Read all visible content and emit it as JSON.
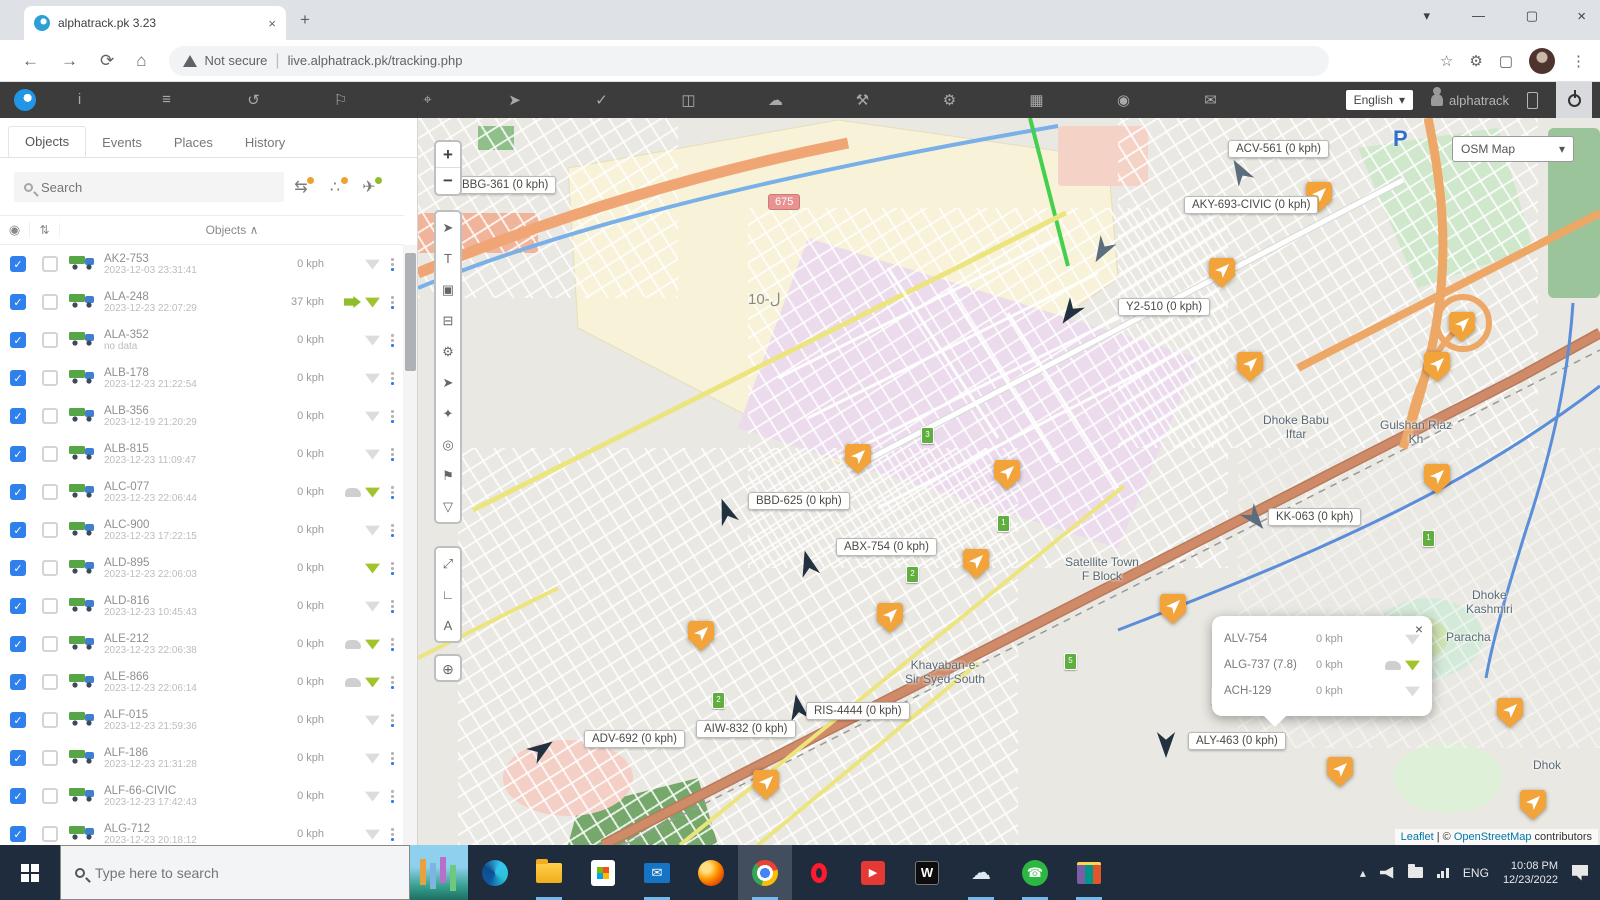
{
  "browser": {
    "tab_title": "alphatrack.pk 3.23",
    "tab_close": "×",
    "new_tab": "+",
    "win_menu": "▾",
    "win_min": "—",
    "win_max": "▢",
    "win_close": "×",
    "back": "←",
    "forward": "→",
    "reload": "⟳",
    "home": "⌂",
    "security": "Not secure",
    "url": "live.alphatrack.pk/tracking.php",
    "star": "☆",
    "menu": "⋮"
  },
  "app_toolbar": {
    "icons": [
      {
        "name": "info"
      },
      {
        "name": "objects-list"
      },
      {
        "name": "history"
      },
      {
        "name": "places"
      },
      {
        "name": "zoom"
      },
      {
        "name": "measure"
      },
      {
        "name": "tasks"
      },
      {
        "name": "reports"
      },
      {
        "name": "weather"
      },
      {
        "name": "tools"
      },
      {
        "name": "settings"
      },
      {
        "name": "table"
      },
      {
        "name": "camera"
      },
      {
        "name": "chat"
      }
    ],
    "language": "English",
    "language_caret": "▾",
    "user": "alphatrack"
  },
  "sidebar": {
    "tabs": [
      "Objects",
      "Events",
      "Places",
      "History"
    ],
    "active_tab": "Objects",
    "search_placeholder": "Search",
    "action_icons": [
      {
        "name": "vehicles-sync"
      },
      {
        "name": "share"
      },
      {
        "name": "follow-plane"
      }
    ],
    "column_header": "Objects",
    "sort_caret": "∧",
    "rows": [
      {
        "name": "AK2-753",
        "datetime": "2023-12-03 23:31:41",
        "speed": "0 kph",
        "icons": [
          "signal-gray"
        ]
      },
      {
        "name": "ALA-248",
        "datetime": "2023-12-23 22:07:29",
        "speed": "37 kph",
        "icons": [
          "arrow-green",
          "signal-green"
        ]
      },
      {
        "name": "ALA-352",
        "datetime": "no data",
        "speed": "0 kph",
        "icons": [
          "signal-gray"
        ]
      },
      {
        "name": "ALB-178",
        "datetime": "2023-12-23 21:22:54",
        "speed": "0 kph",
        "icons": [
          "signal-gray"
        ]
      },
      {
        "name": "ALB-356",
        "datetime": "2023-12-19 21:20:29",
        "speed": "0 kph",
        "icons": [
          "signal-gray"
        ]
      },
      {
        "name": "ALB-815",
        "datetime": "2023-12-23 11:09:47",
        "speed": "0 kph",
        "icons": [
          "signal-gray"
        ]
      },
      {
        "name": "ALC-077",
        "datetime": "2023-12-23 22:06:44",
        "speed": "0 kph",
        "icons": [
          "car-gray",
          "signal-green"
        ]
      },
      {
        "name": "ALC-900",
        "datetime": "2023-12-23 17:22:15",
        "speed": "0 kph",
        "icons": [
          "signal-gray"
        ]
      },
      {
        "name": "ALD-895",
        "datetime": "2023-12-23 22:06:03",
        "speed": "0 kph",
        "icons": [
          "signal-green"
        ]
      },
      {
        "name": "ALD-816",
        "datetime": "2023-12-23 10:45:43",
        "speed": "0 kph",
        "icons": [
          "signal-gray"
        ]
      },
      {
        "name": "ALE-212",
        "datetime": "2023-12-23 22:06:38",
        "speed": "0 kph",
        "icons": [
          "car-gray",
          "signal-green"
        ]
      },
      {
        "name": "ALE-866",
        "datetime": "2023-12-23 22:06:14",
        "speed": "0 kph",
        "icons": [
          "car-gray",
          "signal-green"
        ]
      },
      {
        "name": "ALF-015",
        "datetime": "2023-12-23 21:59:36",
        "speed": "0 kph",
        "icons": [
          "signal-gray"
        ]
      },
      {
        "name": "ALF-186",
        "datetime": "2023-12-23 21:31:28",
        "speed": "0 kph",
        "icons": [
          "signal-gray"
        ]
      },
      {
        "name": "ALF-66-CIVIC",
        "datetime": "2023-12-23 17:42:43",
        "speed": "0 kph",
        "icons": [
          "signal-gray"
        ]
      },
      {
        "name": "ALG-712",
        "datetime": "2023-12-23 20:18:12",
        "speed": "0 kph",
        "icons": [
          "signal-gray"
        ]
      }
    ]
  },
  "map": {
    "layer_label": "OSM Map",
    "layer_caret": "▾",
    "zoom_in": "+",
    "zoom_out": "−",
    "tool_icons": [
      {
        "name": "locate"
      },
      {
        "name": "text-label"
      },
      {
        "name": "clusters"
      },
      {
        "name": "vehicles"
      },
      {
        "name": "settings"
      },
      {
        "name": "measure"
      },
      {
        "name": "bookmarks"
      },
      {
        "name": "visibility"
      },
      {
        "name": "poi"
      },
      {
        "name": "filter"
      }
    ],
    "tool2_icons": [
      {
        "name": "fullscreen"
      },
      {
        "name": "ruler-corner"
      },
      {
        "name": "draw-a"
      }
    ],
    "globe_icon": {
      "name": "minimap-globe"
    },
    "region_label": "10-ل",
    "road_shield": "675",
    "parking": "P",
    "labels": [
      {
        "text": "BBG-361 (0 kph)",
        "x": 36,
        "y": 58
      },
      {
        "text": "ACV-561 (0 kph)",
        "x": 810,
        "y": 22
      },
      {
        "text": "AKY-693-CIVIC (0 kph)",
        "x": 766,
        "y": 78
      },
      {
        "text": "Y2-510 (0 kph)",
        "x": 700,
        "y": 180
      },
      {
        "text": "BBD-625 (0 kph)",
        "x": 330,
        "y": 374
      },
      {
        "text": "ABX-754 (0 kph)",
        "x": 418,
        "y": 420
      },
      {
        "text": "KK-063 (0 kph)",
        "x": 850,
        "y": 390
      },
      {
        "text": "RIS-4444 (0 kph)",
        "x": 388,
        "y": 584
      },
      {
        "text": "AIW-832 (0 kph)",
        "x": 278,
        "y": 602
      },
      {
        "text": "ADV-692 (0 kph)",
        "x": 166,
        "y": 612
      },
      {
        "text": "ALY-463 (0 kph)",
        "x": 770,
        "y": 614
      }
    ],
    "orange_markers": [
      {
        "x": 888,
        "y": 64
      },
      {
        "x": 791,
        "y": 140
      },
      {
        "x": 1031,
        "y": 194
      },
      {
        "x": 1006,
        "y": 234
      },
      {
        "x": 819,
        "y": 234
      },
      {
        "x": 427,
        "y": 326
      },
      {
        "x": 576,
        "y": 342
      },
      {
        "x": 1006,
        "y": 346
      },
      {
        "x": 545,
        "y": 431
      },
      {
        "x": 459,
        "y": 485
      },
      {
        "x": 742,
        "y": 476
      },
      {
        "x": 270,
        "y": 503
      },
      {
        "x": 335,
        "y": 652
      },
      {
        "x": 909,
        "y": 639
      },
      {
        "x": 1079,
        "y": 580
      },
      {
        "x": 1102,
        "y": 672
      }
    ],
    "arrow_markers": [
      {
        "x": 810,
        "y": 40,
        "rot": -30,
        "tone": "gray"
      },
      {
        "x": 672,
        "y": 120,
        "rot": 210,
        "tone": "gray"
      },
      {
        "x": 640,
        "y": 182,
        "rot": 215,
        "tone": "dark"
      },
      {
        "x": 296,
        "y": 380,
        "rot": -20,
        "tone": "dark"
      },
      {
        "x": 378,
        "y": 432,
        "rot": -15,
        "tone": "dark"
      },
      {
        "x": 825,
        "y": 388,
        "rot": 140,
        "tone": "gray"
      },
      {
        "x": 112,
        "y": 618,
        "rot": 55,
        "tone": "dark"
      },
      {
        "x": 368,
        "y": 576,
        "rot": -10,
        "tone": "dark"
      },
      {
        "x": 736,
        "y": 614,
        "rot": 180,
        "tone": "dark"
      }
    ],
    "green_stops": [
      {
        "x": 503,
        "y": 309,
        "n": "3"
      },
      {
        "x": 579,
        "y": 397,
        "n": "1"
      },
      {
        "x": 646,
        "y": 535,
        "n": "5"
      },
      {
        "x": 294,
        "y": 574,
        "n": "2"
      },
      {
        "x": 793,
        "y": 570,
        "n": "4"
      },
      {
        "x": 950,
        "y": 562,
        "n": "3"
      },
      {
        "x": 488,
        "y": 448,
        "n": "2"
      },
      {
        "x": 1004,
        "y": 412,
        "n": "1"
      }
    ],
    "place_names": [
      {
        "lines": [
          "Satellite Town",
          "F Block"
        ],
        "x": 647,
        "y": 437
      },
      {
        "lines": [
          "Khayaban-e-",
          "Sir Syed South"
        ],
        "x": 487,
        "y": 540
      },
      {
        "lines": [
          "Dhoke Babu",
          "Iftar"
        ],
        "x": 845,
        "y": 295
      },
      {
        "lines": [
          "Gulshan Riaz",
          "Kh"
        ],
        "x": 962,
        "y": 300
      },
      {
        "lines": [
          "Dhoke",
          "Kashmiri"
        ],
        "x": 1048,
        "y": 470
      },
      {
        "lines": [
          "Paracha"
        ],
        "x": 1028,
        "y": 512
      },
      {
        "lines": [
          "Dhok"
        ],
        "x": 1115,
        "y": 640
      }
    ],
    "popup": {
      "close": "×",
      "rows": [
        {
          "name": "ALV-754",
          "speed": "0 kph",
          "icons": [
            "signal-gray"
          ]
        },
        {
          "name": "ALG-737 (7.8)",
          "speed": "0 kph",
          "icons": [
            "car-gray",
            "signal-green"
          ]
        },
        {
          "name": "ACH-129",
          "speed": "0 kph",
          "icons": [
            "signal-gray"
          ]
        }
      ]
    },
    "attribution": {
      "leaflet": "Leaflet",
      "sep": " | © ",
      "osm": "OpenStreetMap",
      "suffix": " contributors"
    }
  },
  "taskbar": {
    "search_placeholder": "Type here to search",
    "pinned": [
      {
        "name": "edge",
        "running": false
      },
      {
        "name": "explorer",
        "running": true
      },
      {
        "name": "store",
        "running": false
      },
      {
        "name": "mail",
        "running": true
      },
      {
        "name": "firefox",
        "running": false
      },
      {
        "name": "chrome",
        "running": true,
        "active": true
      },
      {
        "name": "opera",
        "running": false
      },
      {
        "name": "media",
        "running": false
      },
      {
        "name": "wapp",
        "running": false
      },
      {
        "name": "weather",
        "running": true
      },
      {
        "name": "whatsapp",
        "running": true
      },
      {
        "name": "winrar",
        "running": true
      }
    ],
    "tray": {
      "chevron": "▴",
      "lang": "ENG",
      "time": "10:08 PM",
      "date": "12/23/2022"
    }
  },
  "colors": {
    "accent_blue": "#2f80ed",
    "marker_orange": "#f2a43b",
    "signal_green": "#a2c32c",
    "appbar_dark": "#3c3c3c",
    "taskbar_navy": "#1e2c3e"
  }
}
